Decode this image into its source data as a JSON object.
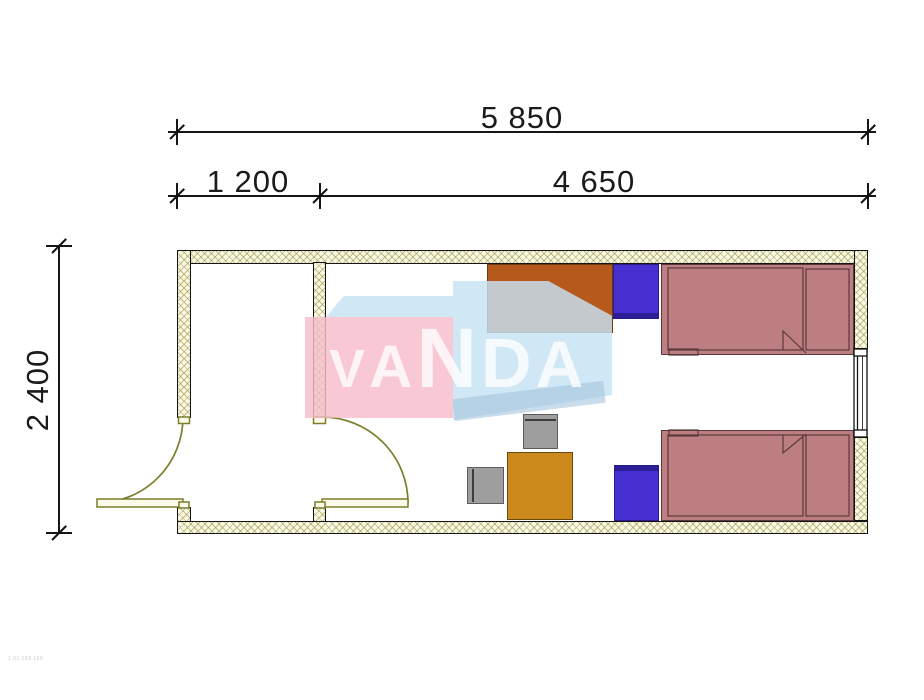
{
  "dimensions": {
    "overall_width": {
      "label": "5 850"
    },
    "left_segment": {
      "label": "1 200"
    },
    "right_segment": {
      "label": "4 650"
    },
    "overall_height": {
      "label": "2 400"
    }
  },
  "watermark": {
    "brand": "VANDA",
    "letters": [
      "V",
      "A",
      "N",
      "D",
      "A"
    ]
  },
  "footer": {
    "code": "1.91.163.169"
  },
  "plan": {
    "rooms": [
      "entry-hall",
      "bedroom"
    ],
    "openings": [
      "entrance-door",
      "interior-door",
      "window"
    ],
    "furniture": [
      "wardrobe",
      "nightstand",
      "bed",
      "bed",
      "nightstand",
      "desk",
      "chair",
      "chair"
    ]
  },
  "colors": {
    "wall_fill": "#fbf9e6",
    "wall_hatch": "rgba(152,152,70,0.6)",
    "door": "#7d7d2b",
    "bed": "#bd7e81",
    "bed_line": "#59383b",
    "nightstand": "#4630d2",
    "wardrobe": "#b5591c",
    "desk": "#cc8a1d",
    "chair": "#9e9e9e",
    "dim": "#161616",
    "wm_pink": "rgba(246,189,203,0.82)",
    "wm_blue": "rgba(198,226,243,0.82)",
    "wm_text": "rgba(255,255,255,0.78)"
  }
}
